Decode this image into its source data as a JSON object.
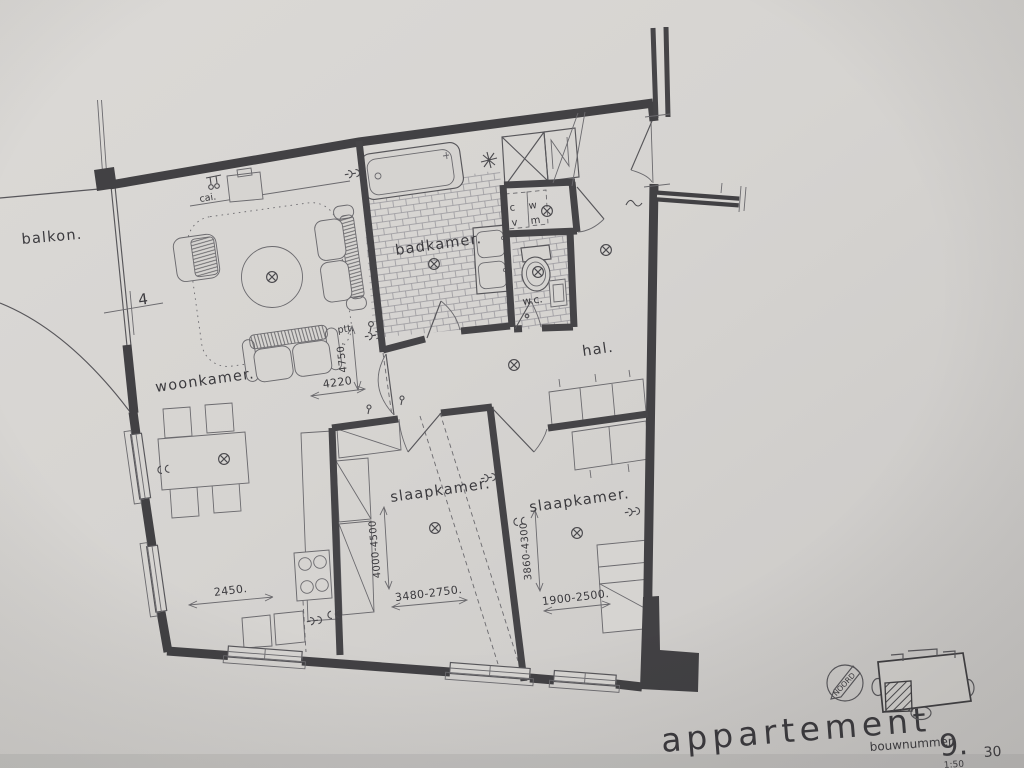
{
  "colors": {
    "paper": "#d6d4d1",
    "wall_ink": "#424144",
    "line_ink": "#57565a",
    "text_ink": "#3b3a3e"
  },
  "plan": {
    "rooms": {
      "balkon": "balkon.",
      "woonkamer": "woonkamer.",
      "badkamer": "badkamer.",
      "hal": "hal.",
      "slaapkamer_1": "slaapkamer.",
      "slaapkamer_2": "slaapkamer.",
      "wc": "w.c."
    },
    "annotations": {
      "cai": "cai.",
      "ptt": "ptt.",
      "cv_top": "c",
      "cv_bottom": "v",
      "wm_top": "w",
      "wm_bottom": "m",
      "balcony_door_marker": "4"
    },
    "dimensions": {
      "woonkamer_depth": "4750.",
      "hal_opening": "4220",
      "kitchen_width": "2450.",
      "slaapkamer_1_depth": "4000-4500",
      "slaapkamer_1_width": "3480-2750.",
      "slaapkamer_2_depth": "3860-4300",
      "slaapkamer_2_width": "1900-2500."
    }
  },
  "title_block": {
    "title": "appartement",
    "bouwnummer_label": "bouwnummer:",
    "bouwnummer_value": "9.",
    "scale": "1:50",
    "sheet_number": "30"
  },
  "key_plan": {
    "north_label": "NOORD"
  }
}
